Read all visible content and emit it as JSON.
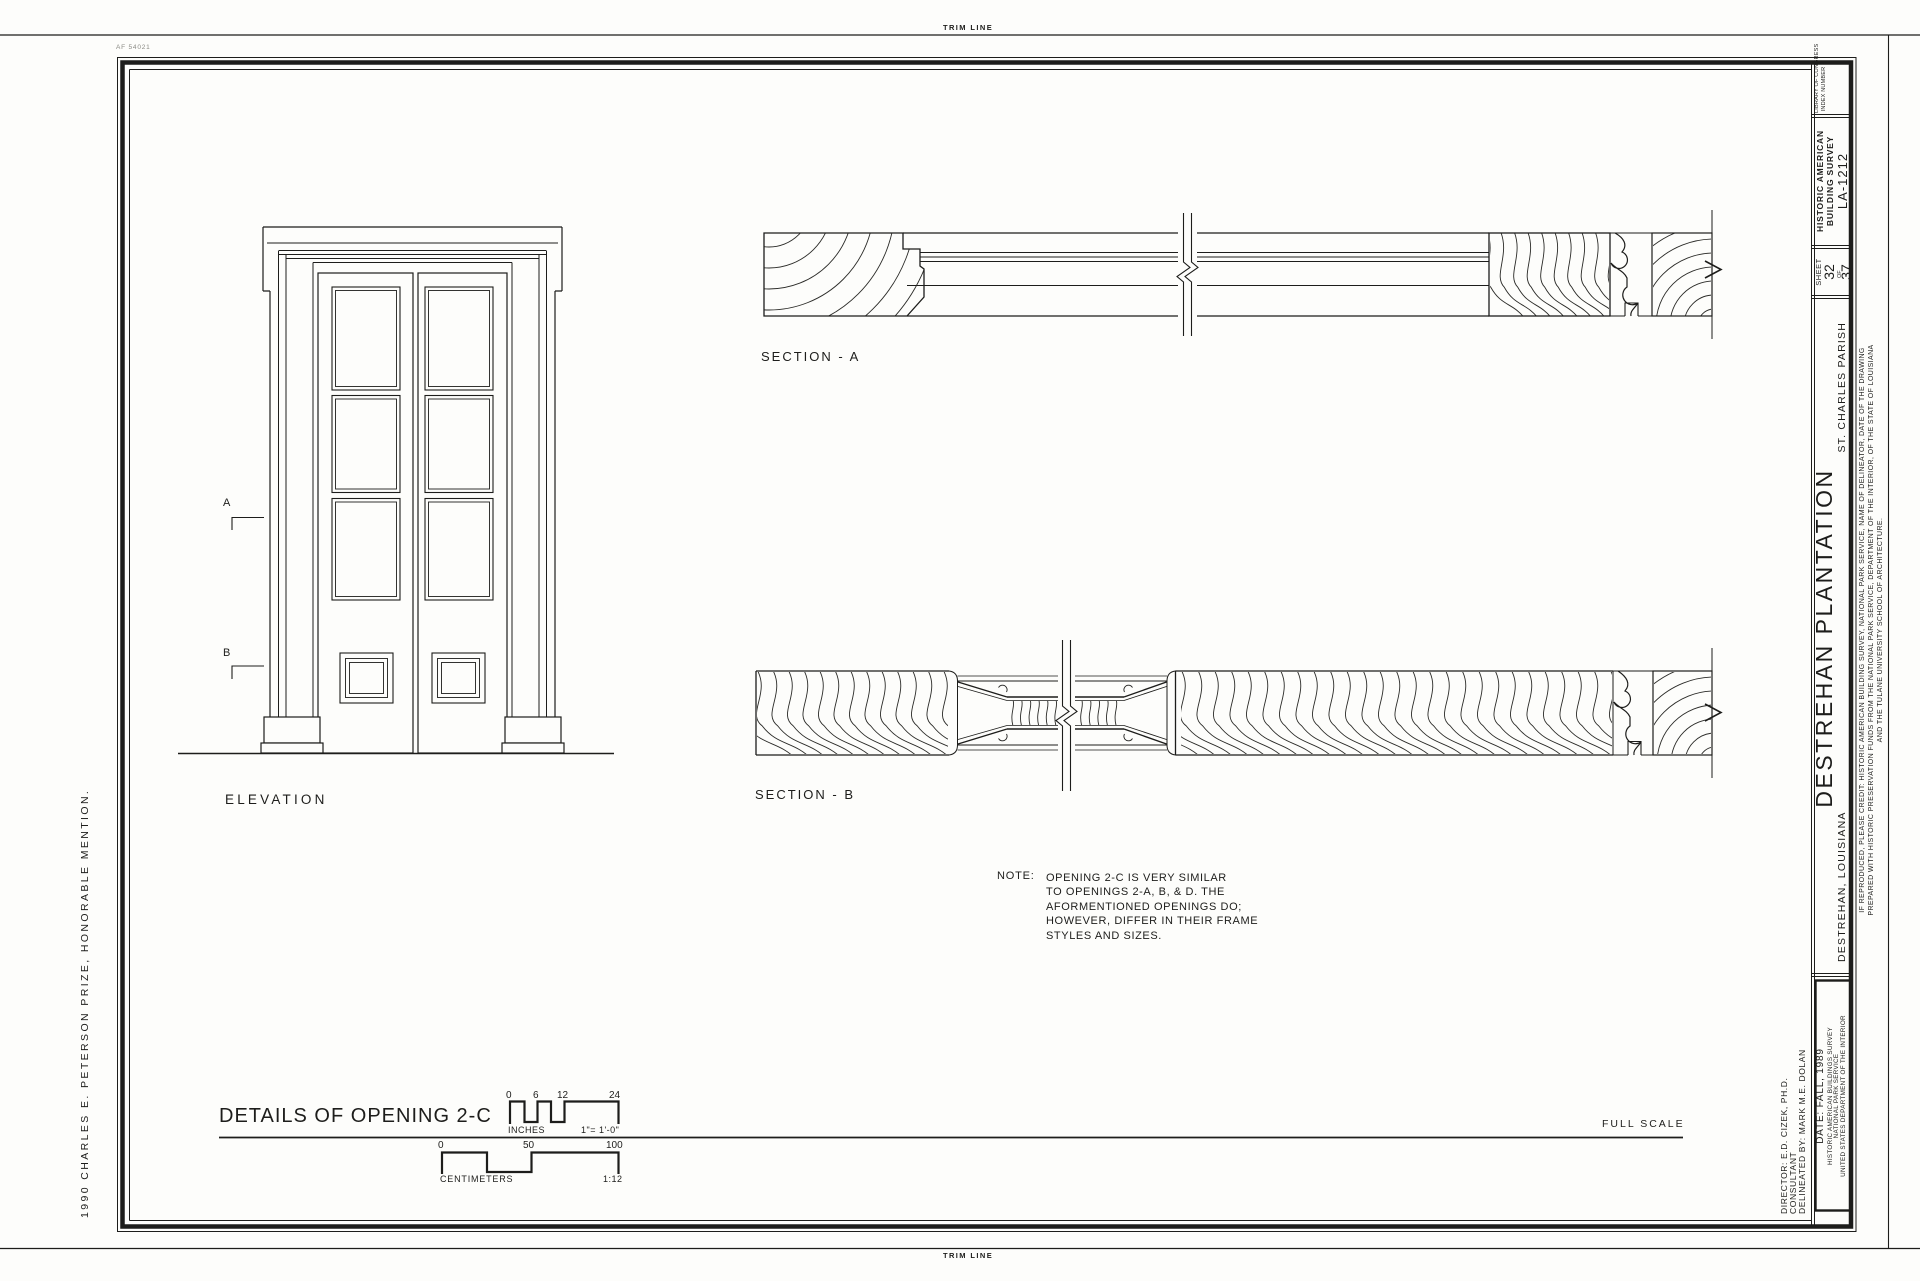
{
  "page": {
    "trim_label_top": "TRIM LINE",
    "trim_label_bottom": "TRIM LINE",
    "stamp": "AF 54021",
    "margin_award": "1990 CHARLES E. PETERSON PRIZE, HONORABLE MENTION."
  },
  "titleblock": {
    "library_congress": "LIBRARY OF CONGRESS",
    "index_number": "INDEX NUMBER",
    "survey_line1": "HISTORIC AMERICAN",
    "survey_line2": "BUILDING SURVEY",
    "survey_number": "LA-1212",
    "sheet_label": "SHEET",
    "sheet_number": "32",
    "sheet_of": "OF",
    "sheet_total": "37",
    "parish": "ST. CHARLES PARISH",
    "title": "DESTREHAN  PLANTATION",
    "location": "DESTREHAN,  LOUISIANA",
    "credit_line1": "IF REPRODUCED, PLEASE CREDIT: HISTORIC AMERICAN BUILDING SURVEY, NATIONAL PARK SERVICE, NAME OF DELINEATOR, DATE OF THE DRAWING",
    "credit_line2": "PREPARED WITH HISTORIC PRESERVATION FUNDS FROM THE NATIONAL PARK SERVICE, DEPARTMENT OF THE INTERIOR, OF THE STATE OF LOUISIANA",
    "credit_line3": "AND THE TULANE UNIVERSITY SCHOOL OF ARCHITECTURE.",
    "director": "DIRECTOR: E.D. CIZEK, PH.D.",
    "consultant": "CONSULTANT",
    "delineated": "DELINEATED BY: MARK M.E. DOLAN",
    "date": "DATE: FALL, 1989",
    "habs": "HISTORIC AMERICAN BUILDINGS SURVEY",
    "nps": "NATIONAL PARK SERVICE",
    "usdoi": "UNITED STATES DEPARTMENT OF THE INTERIOR"
  },
  "drawing": {
    "elevation_label": "ELEVATION",
    "section_a_label": "SECTION - A",
    "section_b_label": "SECTION - B",
    "marker_a": "A",
    "marker_b": "B",
    "note_label": "NOTE:",
    "note_lines": [
      "OPENING 2-C IS VERY SIMILAR",
      "TO OPENINGS 2-A, B, & D. THE",
      "AFORMENTIONED OPENINGS DO;",
      "HOWEVER, DIFFER IN THEIR FRAME",
      "STYLES AND SIZES."
    ],
    "sheet_title": "DETAILS OF OPENING 2-C",
    "full_scale": "FULL  SCALE"
  },
  "scales": {
    "inches": {
      "label": "INCHES",
      "ticks": [
        "0",
        "6",
        "12",
        "24"
      ],
      "ratio": "1\"= 1'-0\""
    },
    "centimeters": {
      "label": "CENTIMETERS",
      "ticks": [
        "0",
        "50",
        "100"
      ],
      "ratio": "1:12"
    }
  },
  "colors": {
    "ink": "#1d1d1b",
    "paper": "#fdfdfb",
    "stamp_gray": "#8a8a84"
  }
}
